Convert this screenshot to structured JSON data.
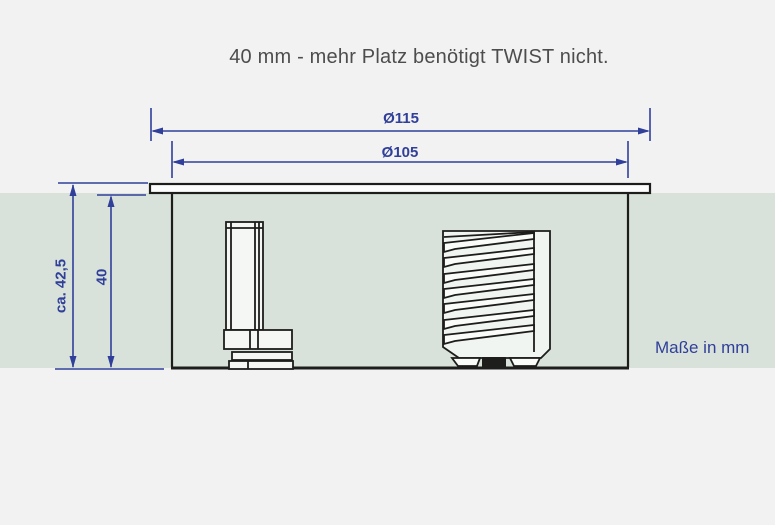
{
  "title": "40 mm - mehr Platz benötigt TWIST nicht.",
  "note": "Maße in mm",
  "dimensions": {
    "outer_diameter": "Ø115",
    "inner_diameter": "Ø105",
    "total_depth": "ca. 42,5",
    "recess_depth": "40"
  },
  "colors": {
    "background": "#f2f2f2",
    "tabletop_band": "#d8e2da",
    "dimension_blue": "#303f9a",
    "drawing_black": "#1d1d1b",
    "title_gray": "#4d4d4d"
  }
}
